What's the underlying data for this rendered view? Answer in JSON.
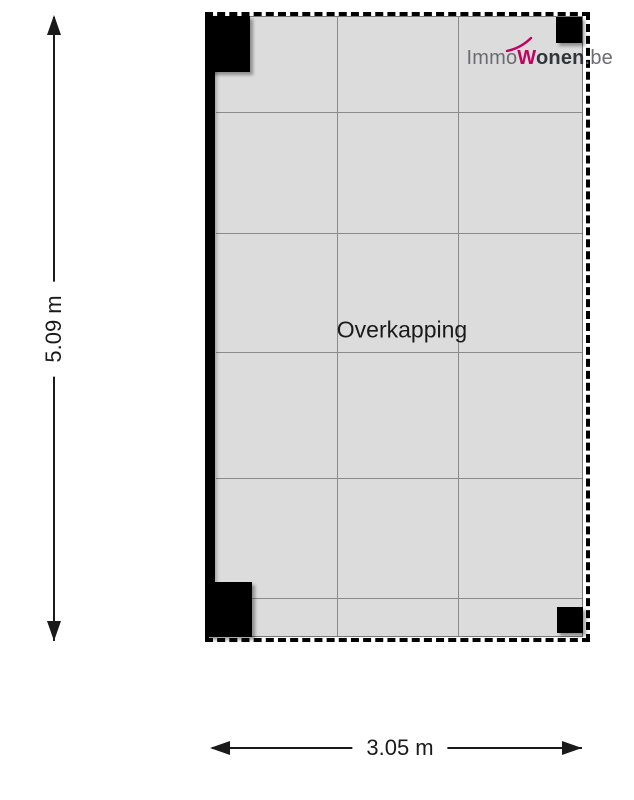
{
  "logo": {
    "prefix": "Immo",
    "accent_letter": "W",
    "middle": "onen",
    "suffix": ".be"
  },
  "plan": {
    "room_label": "Overkapping"
  },
  "dimensions": {
    "vertical_label": "5.09 m",
    "horizontal_label": "3.05 m"
  },
  "colors": {
    "floor_fill": "#dcdcdc",
    "grid_line": "#8a8a8a",
    "wall_black": "#000000",
    "logo_accent": "#c0035f",
    "logo_gray": "#6b6b74",
    "logo_dark": "#34343f",
    "dimension_text": "#1a1a1a"
  }
}
